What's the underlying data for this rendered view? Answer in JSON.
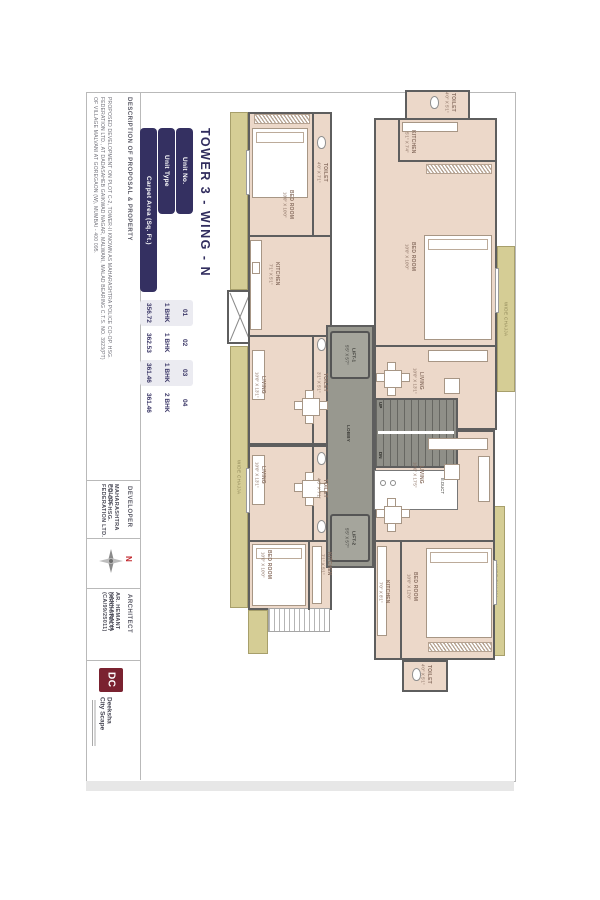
{
  "title_table": {
    "title": "TOWER 3 - WING - N",
    "headers": [
      "Unit No.",
      "Unit Type",
      "Carpet Area (Sq. Ft.)"
    ],
    "rows": [
      {
        "no": "01",
        "type": "1 BHK",
        "area": "356.72"
      },
      {
        "no": "02",
        "type": "1 BHK",
        "area": "362.53"
      },
      {
        "no": "03",
        "type": "1 BHK",
        "area": "361.46"
      },
      {
        "no": "04",
        "type": "2 BHK",
        "area": "361.46"
      }
    ]
  },
  "description": {
    "label": "DESCRIPTION OF PROPOSAL & PROPERTY",
    "lines": [
      "PROPOSED DEVELOPMENT ON PLOT C-2, TOWER-II KNOWN AS MAHARASHTRA POLICE CO-OP. HSG.",
      "FEDERATION LTD., AT DADASAHEB GAIKWAD NAGAR, MALWANI, MALAD BEARING C.T.S. NO. 3923(PT)",
      "OF VILLAGE MALVANI AT GOREGAON (W), MUMBAI - 400 095."
    ]
  },
  "developer": {
    "label": "DEVELOPER",
    "lines": [
      "MAHARASHTRA POLICE",
      "CO-OP. HSG. FEDERATION LTD."
    ]
  },
  "compass": {
    "north": "N"
  },
  "architect": {
    "label": "ARCHITECT",
    "lines": [
      "AR. HEMANT KANKARAIYA",
      "(ARCHITECT) (CA/99/25011)"
    ]
  },
  "logo": {
    "initials": "DC",
    "name_line1": "Deeksha",
    "name_line2": "City Scape"
  },
  "plan": {
    "chajja_label": "WIDE CHAJJA",
    "core": {
      "lift1_name": "LIFT-1",
      "lift1_dims": "5'5\" X 5'7\"",
      "lift2_name": "LIFT-2",
      "lift2_dims": "5'5\" X 5'7\"",
      "lobby": "LOBBY",
      "up": "UP",
      "dn": "DN",
      "duct": "E.DUCT"
    },
    "rooms": {
      "a_bed": {
        "name": "BED ROOM",
        "dims": "10'0\" X 10'0\""
      },
      "a_toilet1": {
        "name": "TOILET",
        "dims": "4'0\" X 7'1\""
      },
      "a_toilet2": {
        "name": "TOILET",
        "dims": "3'1\" X 5'1\""
      },
      "a_kitchen": {
        "name": "KITCHEN",
        "dims": "7'1\" X 5'1\""
      },
      "a_living": {
        "name": "LIVING",
        "dims": "10'0\" X 13'1\""
      },
      "b_living": {
        "name": "LIVING",
        "dims": "10'0\" X 13'1\""
      },
      "b_toilet": {
        "name": "TOILET",
        "dims": "4'0\" X 7'1\""
      },
      "b_kitchen": {
        "name": "KITCHEN",
        "dims": "7'1\" X 5'1\""
      },
      "b_bed": {
        "name": "BED ROOM",
        "dims": "10'0\" X 10'0\""
      },
      "c_toilet": {
        "name": "TOILET",
        "dims": "4'0\" X 5'1\""
      },
      "c_kitchen": {
        "name": "KITCHEN",
        "dims": "5'1\" X 7'4\""
      },
      "c_bed": {
        "name": "BED ROOM",
        "dims": "10'0\" X 10'0\""
      },
      "c_living": {
        "name": "LIVING",
        "dims": "10'0\" X 13'1\""
      },
      "d_living": {
        "name": "LIVING",
        "dims": "10'0\" X 17'5\""
      },
      "d_bed": {
        "name": "BED ROOM",
        "dims": "10'0\" X 12'0\""
      },
      "d_kitchen": {
        "name": "KITCHEN",
        "dims": "7'0\" X 8'1\""
      },
      "d_toilet": {
        "name": "TOILET",
        "dims": "4'0\" X 5'1\""
      }
    }
  }
}
